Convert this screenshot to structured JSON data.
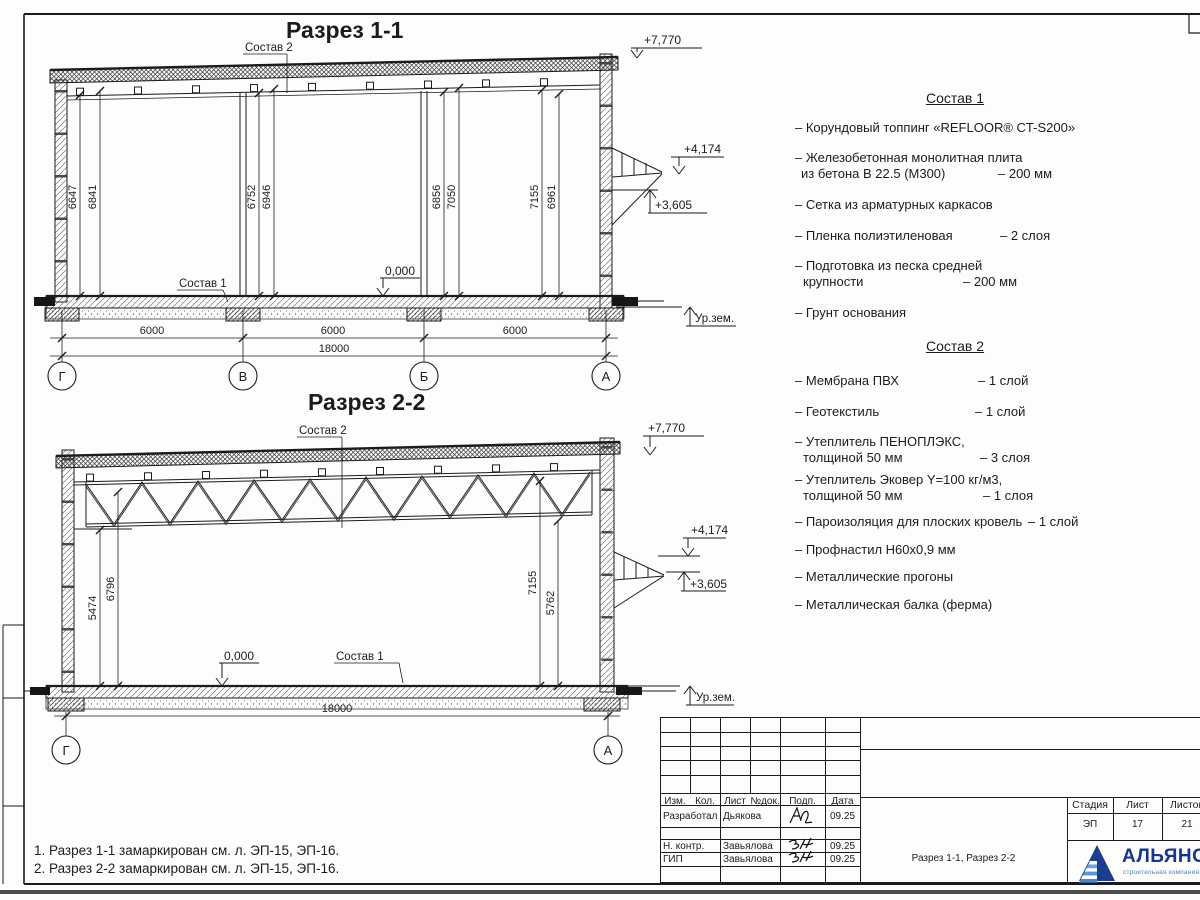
{
  "s11": {
    "title": "Разрез 1-1",
    "sostav1_label": "Состав 1",
    "sostav2_label": "Состав 2",
    "elev_roof": "+7,770",
    "elev_canopy_top": "+4,174",
    "elev_canopy_bot": "+3,605",
    "elev_zero": "0,000",
    "ground_label": "Ур.зем.",
    "dims": [
      "6647",
      "6841",
      "6752",
      "6946",
      "6856",
      "7050",
      "7155",
      "6961"
    ],
    "spans": [
      "6000",
      "6000",
      "6000"
    ],
    "total": "18000",
    "axes": [
      "Г",
      "В",
      "Б",
      "А"
    ]
  },
  "s22": {
    "title": "Разрез 2-2",
    "sostav1_label": "Состав 1",
    "sostav2_label": "Состав 2",
    "elev_roof": "+7,770",
    "elev_canopy_top": "+4,174",
    "elev_canopy_bot": "+3,605",
    "elev_zero": "0,000",
    "ground_label": "Ур.зем.",
    "dims": [
      "5474",
      "6796",
      "7155",
      "5762"
    ],
    "total": "18000",
    "axes": [
      "Г",
      "А"
    ]
  },
  "sostav1": {
    "title": "Состав 1",
    "i1": {
      "t": "– Корундовый топпинг «REFLOOR® CT-S200»"
    },
    "i2a": {
      "t": "– Железобетонная  монолитная плита"
    },
    "i2b": {
      "t": "из бетона В 22.5 (М300)",
      "v": "– 200 мм"
    },
    "i3": {
      "t": "– Сетка из арматурных каркасов"
    },
    "i4": {
      "t": "– Пленка полиэтиленовая",
      "v": "– 2 слоя"
    },
    "i5a": {
      "t": "– Подготовка из песка средней"
    },
    "i5b": {
      "t": "крупности",
      "v": "– 200 мм"
    },
    "i6": {
      "t": "– Грунт основания"
    }
  },
  "sostav2": {
    "title": "Состав 2",
    "i1": {
      "t": "– Мембрана ПВХ",
      "v": "– 1 слой"
    },
    "i2": {
      "t": "– Геотекстиль",
      "v": "– 1 слой"
    },
    "i3a": {
      "t": "– Утеплитель ПЕНОПЛЭКС,"
    },
    "i3b": {
      "t": "толщиной 50 мм",
      "v": "– 3 слоя"
    },
    "i4a": {
      "t": "– Утеплитель Эковер Y=100 кг/м3,"
    },
    "i4b": {
      "t": "толщиной 50 мм",
      "v": "– 1 слоя"
    },
    "i5": {
      "t": "– Пароизоляция для плоских кровель",
      "v": "– 1 слой"
    },
    "i6": {
      "t": "– Профнастил Н60х0,9 мм"
    },
    "i7": {
      "t": "– Металлические прогоны"
    },
    "i8": {
      "t": "– Металлическая балка (ферма)"
    }
  },
  "notes": {
    "line1": "1. Разрез 1-1 замаркирован см. л. ЭП-15, ЭП-16.",
    "line2": "2. Разрез 2-2 замаркирован см. л. ЭП-15, ЭП-16."
  },
  "titleblock": {
    "headers": [
      "Изм.",
      "Кол.",
      "Лист",
      "№док.",
      "Подп.",
      "Дата"
    ],
    "rows": [
      {
        "role": "Разработал",
        "name": "Дьякова",
        "date": "09.25"
      },
      {
        "role": "Н. контр.",
        "name": "Завьялова",
        "date": "09.25"
      },
      {
        "role": "ГИП",
        "name": "Завьялова",
        "date": "09.25"
      }
    ],
    "doc_title": "Разрез 1-1, Разрез 2-2",
    "stage": {
      "h1": "Стадия",
      "h2": "Лист",
      "h3": "Листов",
      "v1": "ЭП",
      "v2": "17",
      "v3": "21"
    }
  },
  "logo": {
    "name": "АЛЬЯНС",
    "subtitle": "строительная компания"
  },
  "colors": {
    "line": "#1c1c1c",
    "logo_blue": "#16368c",
    "logo_light": "#4a86c8"
  }
}
